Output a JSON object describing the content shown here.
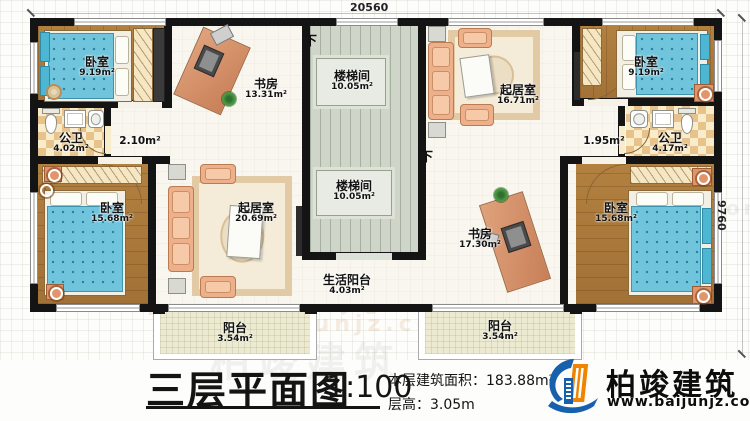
{
  "dimensions": {
    "width_mm": "20560",
    "depth_mm": "9760"
  },
  "stairs": {
    "down": "下"
  },
  "rooms": {
    "bedroom_tl": {
      "name": "卧室",
      "area": "9.19m²"
    },
    "study_tl": {
      "name": "书房",
      "area": "13.31m²"
    },
    "stair_top": {
      "name": "楼梯间",
      "area": "10.05m²"
    },
    "living_tr": {
      "name": "起居室",
      "area": "16.71m²"
    },
    "bedroom_tr": {
      "name": "卧室",
      "area": "9.19m²"
    },
    "bath_left": {
      "name": "公卫",
      "area": "4.02m²"
    },
    "hall_left": {
      "area": "2.10m²"
    },
    "hall_right": {
      "area": "1.95m²"
    },
    "bath_right": {
      "name": "公卫",
      "area": "4.17m²"
    },
    "bedroom_ml": {
      "name": "卧室",
      "area": "15.68m²"
    },
    "living_center": {
      "name": "起居室",
      "area": "20.69m²"
    },
    "stair_bottom": {
      "name": "楼梯间",
      "area": "10.05m²"
    },
    "study_br": {
      "name": "书房",
      "area": "17.30m²"
    },
    "bedroom_mr": {
      "name": "卧室",
      "area": "15.68m²"
    },
    "service_balcony": {
      "name": "生活阳台",
      "area": "4.03m²"
    },
    "balcony_left": {
      "name": "阳台",
      "area": "3.54m²"
    },
    "balcony_right": {
      "name": "阳台",
      "area": "3.54m²"
    }
  },
  "titleblock": {
    "title": "三层平面图",
    "scale": "1:100",
    "floor_area": "本层建筑面积：183.88m²",
    "floor_height": "层高：3.05m"
  },
  "branding": {
    "company": "柏竣建筑",
    "website": "www.baijunjz.com"
  },
  "colors": {
    "wall": "#141414",
    "logo_blue": "#1760ab",
    "logo_orange": "#f08300"
  }
}
